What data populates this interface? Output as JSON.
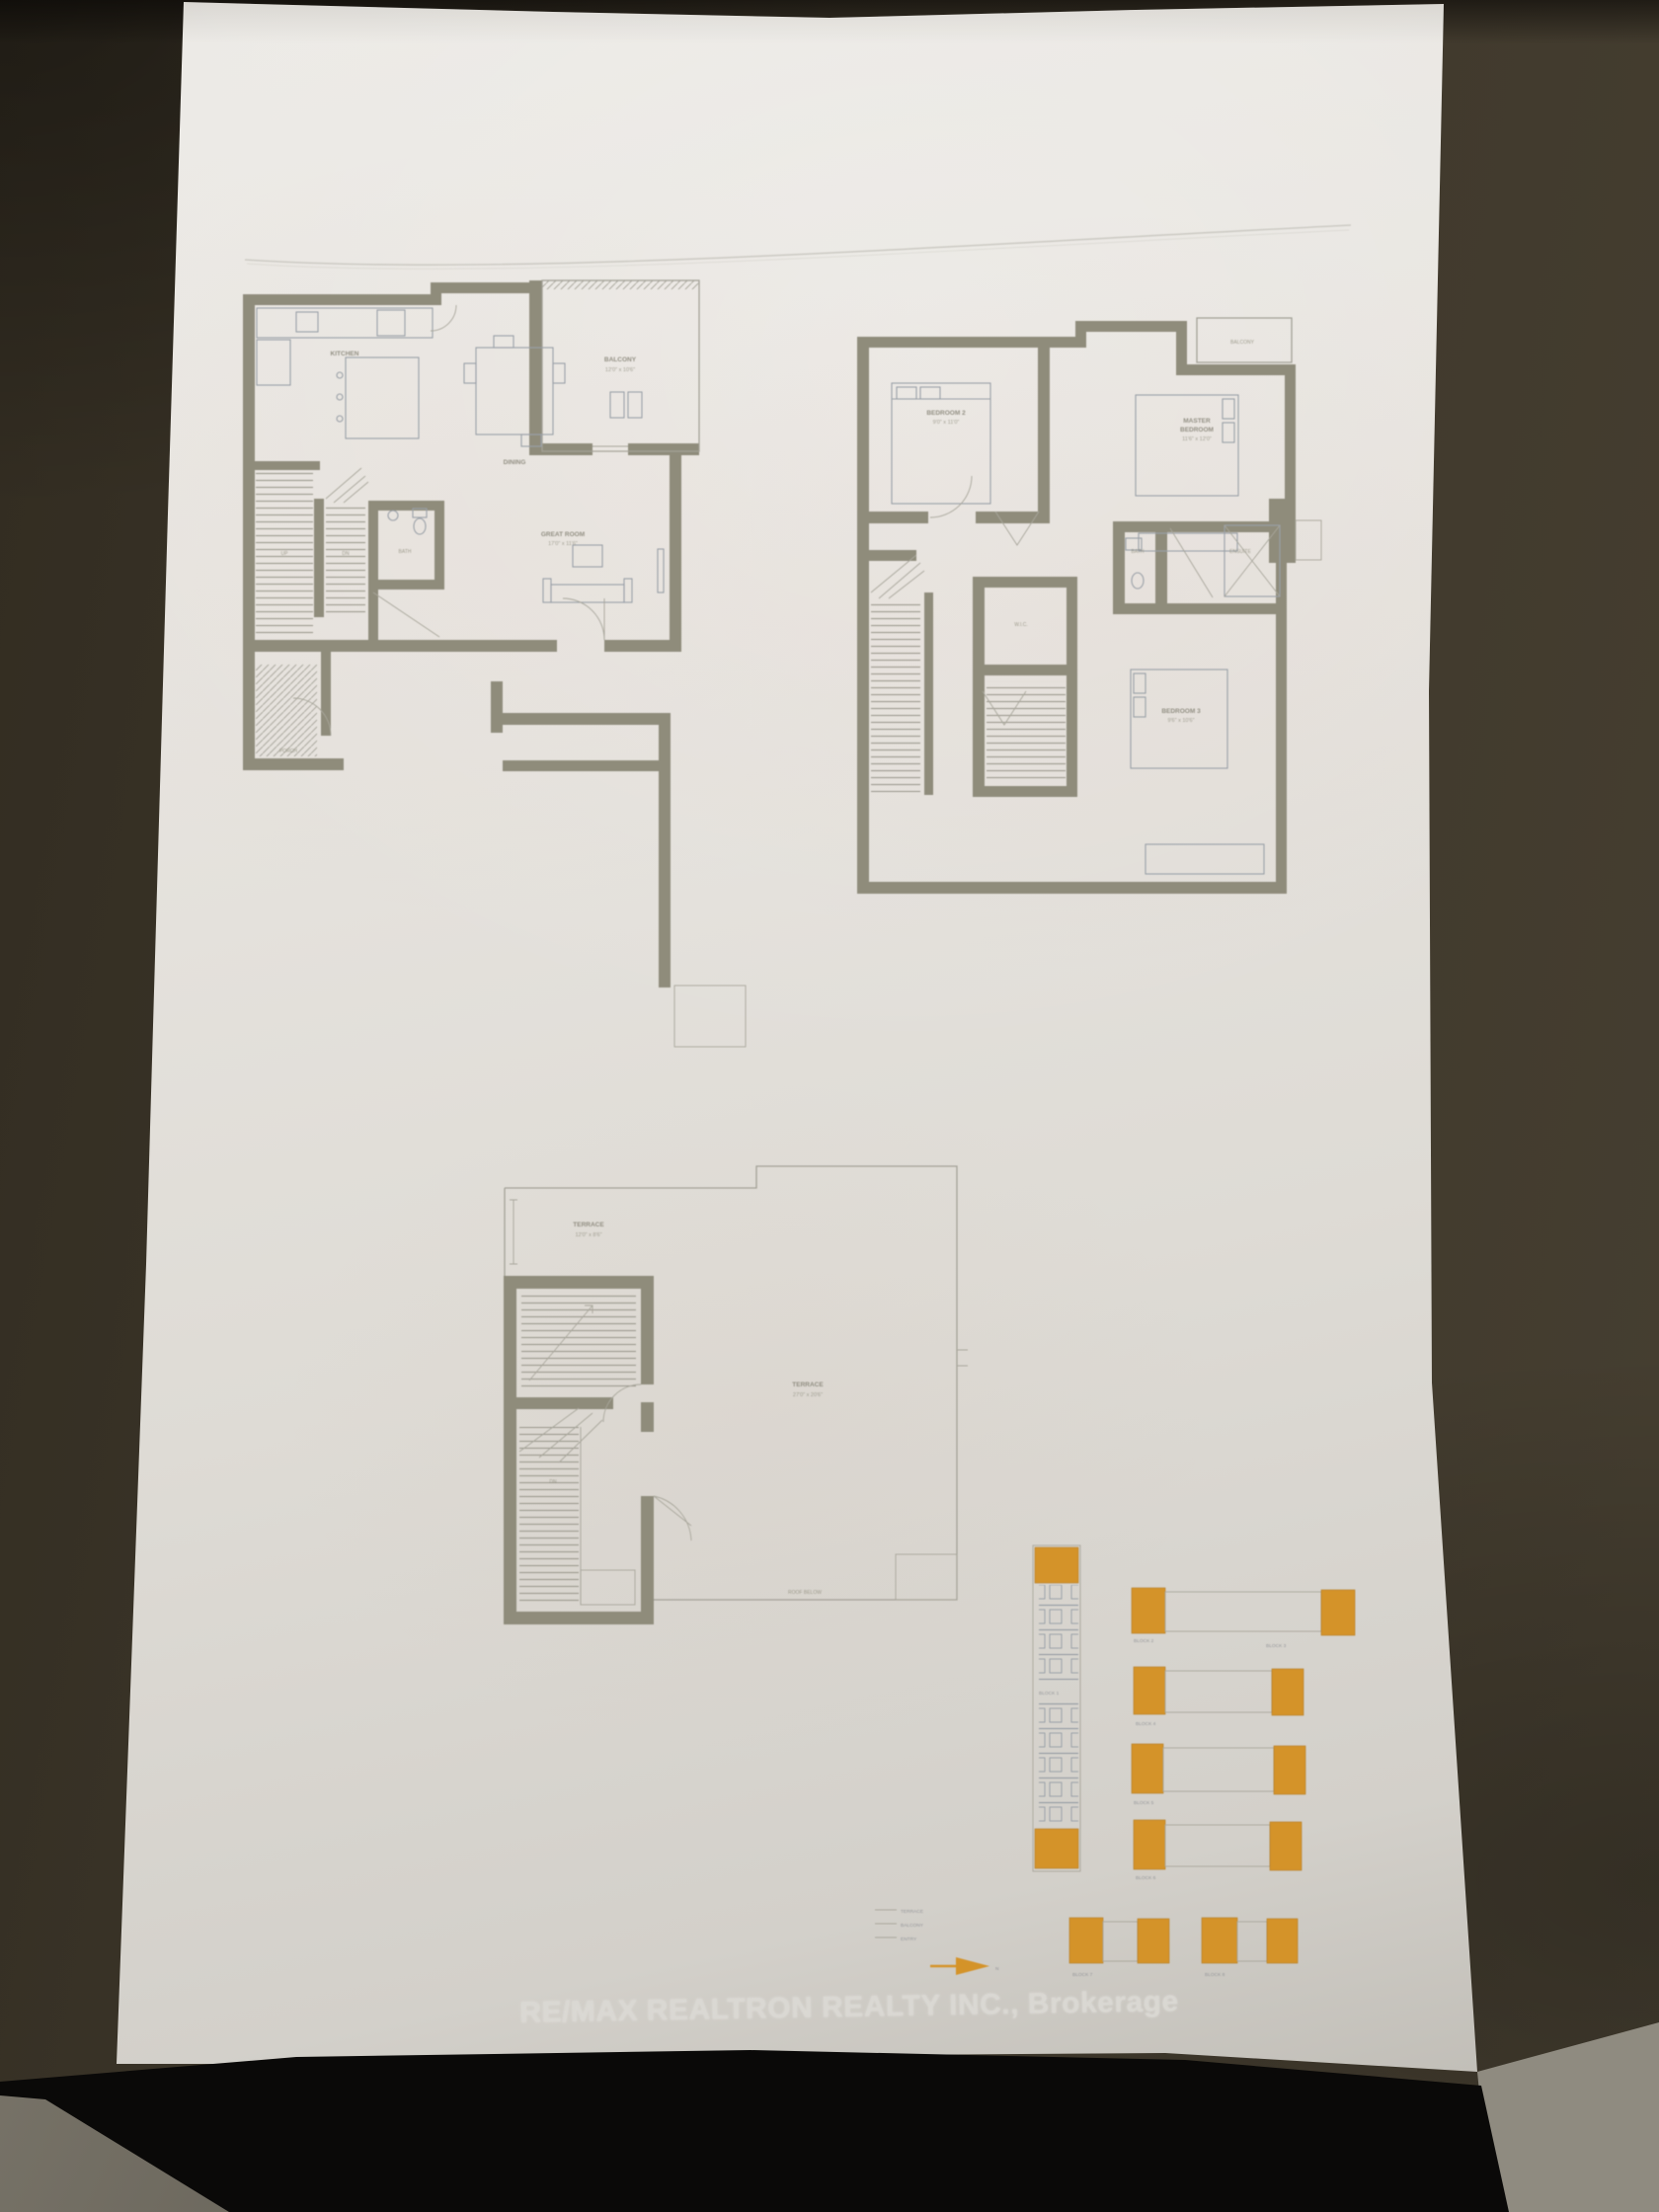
{
  "photo": {
    "surface": "dark wood table",
    "colors": {
      "background": "#3e382c",
      "paper": "#e3e0da",
      "walls": "#8f8c7a",
      "thin_lines": "#a3a196",
      "furniture_lines": "#99a0a8",
      "highlight_orange": "#d9921f",
      "label_text": "#8a8779",
      "footer_text": "#dbd9d4",
      "bottom_shadow": "#0a0908"
    }
  },
  "sheet": {
    "footer": {
      "brokerage": "RE/MAX REALTRON REALTY INC., Brokerage"
    },
    "plans": {
      "main_floor": {
        "title": "main floor plan",
        "rooms": {
          "kitchen": {
            "label": "KITCHEN"
          },
          "dining": {
            "label": "DINING"
          },
          "great_room": {
            "label": "GREAT ROOM",
            "dims": "17'0\" x 11'6\""
          },
          "balcony": {
            "label": "BALCONY",
            "dims": "12'0\" x 10'6\""
          },
          "powder": {
            "label": "BATH"
          },
          "porch": {
            "label": "PORCH"
          },
          "stairs_up": "UP",
          "stairs_dn": "DN"
        }
      },
      "second_floor": {
        "title": "second floor plan",
        "rooms": {
          "bedroom2": {
            "label": "BEDROOM 2",
            "dims": "9'0\" x 11'0\""
          },
          "master": {
            "line1": "MASTER",
            "line2": "BEDROOM",
            "dims": "11'6\" x 12'0\""
          },
          "bedroom3": {
            "label": "BEDROOM 3",
            "dims": "9'6\" x 10'6\""
          },
          "bath": {
            "label": "BATH"
          },
          "ensuite": {
            "label": "ENSUITE"
          },
          "wic": {
            "label": "W.I.C."
          },
          "balcony": {
            "label": "BALCONY"
          }
        }
      },
      "terrace_floor": {
        "title": "rooftop terrace plan",
        "rooms": {
          "terrace_small": {
            "label": "TERRACE",
            "dims": "12'0\" x 8'6\""
          },
          "terrace_main": {
            "label": "TERRACE",
            "dims": "27'0\" x 20'6\""
          },
          "roof_note": "ROOF BELOW",
          "stairs_dn": "DN"
        }
      }
    },
    "site_key": {
      "blocks": [
        {
          "label": "BLOCK 1"
        },
        {
          "label": "BLOCK 2"
        },
        {
          "label": "BLOCK 3"
        },
        {
          "label": "BLOCK 4"
        },
        {
          "label": "BLOCK 5"
        },
        {
          "label": "BLOCK 6"
        },
        {
          "label": "BLOCK 7"
        },
        {
          "label": "BLOCK 8"
        }
      ],
      "legend_items": [
        "TERRACE",
        "BALCONY",
        "ENTRY"
      ],
      "north_marker": "N"
    }
  }
}
